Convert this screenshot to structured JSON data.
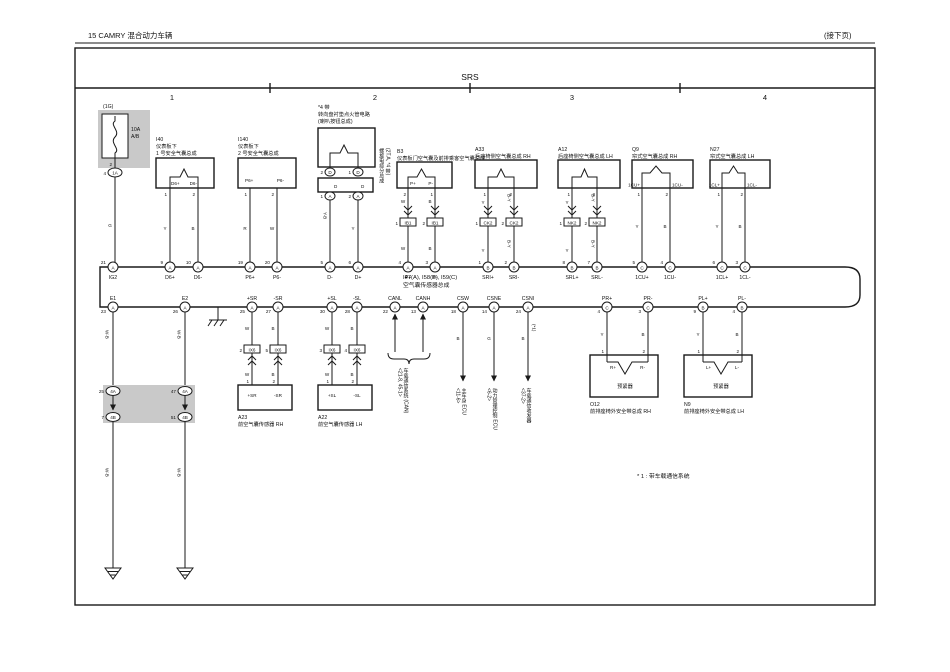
{
  "page": {
    "header_left": "15   CAMRY 混合动力车辆",
    "header_right": "(接下页)",
    "title": "SRS",
    "s1": "1",
    "s2": "2",
    "s3": "3",
    "s4": "4",
    "footnote": "* 1 : 带车载通信系统"
  },
  "fuse": {
    "conn": "(1G)",
    "amp": "10A",
    "name": "A/B",
    "pin": "2",
    "num": "4",
    "letter": "1A",
    "color": "G"
  },
  "ecu": {
    "l1": "I47(A), I58(B), I59(C)",
    "l2": "空气囊传感器总成",
    "top": [
      {
        "n": "21",
        "l": "A",
        "t": "IG2"
      },
      {
        "n": "9",
        "l": "A",
        "t": "D6+"
      },
      {
        "n": "10",
        "l": "A",
        "t": "D6-"
      },
      {
        "n": "19",
        "l": "A",
        "t": "P6+"
      },
      {
        "n": "20",
        "l": "A",
        "t": "P6-"
      },
      {
        "n": "5",
        "l": "A",
        "t": "D-"
      },
      {
        "n": "6",
        "l": "A",
        "t": "D+"
      },
      {
        "n": "4",
        "l": "A",
        "t": "P+"
      },
      {
        "n": "3",
        "l": "A",
        "t": "P-"
      },
      {
        "n": "1",
        "l": "B",
        "t": "SRI+"
      },
      {
        "n": "2",
        "l": "B",
        "t": "SRI-"
      },
      {
        "n": "8",
        "l": "B",
        "t": "SRL+"
      },
      {
        "n": "7",
        "l": "B",
        "t": "SRL-"
      },
      {
        "n": "5",
        "l": "C",
        "t": "1CU+"
      },
      {
        "n": "4",
        "l": "C",
        "t": "1CU-"
      },
      {
        "n": "6",
        "l": "C",
        "t": "1CL+"
      },
      {
        "n": "3",
        "l": "C",
        "t": "1CL-"
      }
    ],
    "bot": [
      {
        "n": "23",
        "l": "A",
        "t": "E1"
      },
      {
        "n": "26",
        "l": "A",
        "t": "E2"
      },
      {
        "n": "25",
        "l": "A",
        "t": "+SR"
      },
      {
        "n": "27",
        "l": "A",
        "t": "-SR"
      },
      {
        "n": "30",
        "l": "A",
        "t": "+SL"
      },
      {
        "n": "28",
        "l": "A",
        "t": "-SL"
      },
      {
        "n": "22",
        "l": "A",
        "t": "CANL"
      },
      {
        "n": "13",
        "l": "A",
        "t": "CANH"
      },
      {
        "n": "18",
        "l": "A",
        "t": "CSW"
      },
      {
        "n": "14",
        "l": "A",
        "t": "CSNE"
      },
      {
        "n": "24",
        "l": "A",
        "t": "CSNI"
      },
      {
        "n": "4",
        "l": "C",
        "t": "PR+"
      },
      {
        "n": "3",
        "l": "C",
        "t": "PR-"
      },
      {
        "n": "9",
        "l": "B",
        "t": "PL+"
      },
      {
        "n": "4",
        "l": "B",
        "t": "PL-"
      }
    ]
  },
  "i40": {
    "code": "I40",
    "l1": "仪表板下",
    "l2": "1 号安全气囊总成",
    "t1": "D6+",
    "t2": "D6-",
    "p1": "1",
    "p2": "2",
    "c1": "Y",
    "c2": "B"
  },
  "i140": {
    "code": "I140",
    "l1": "仪表板下",
    "l2": "2 号安全气囊总成",
    "t1": "P6+",
    "t2": "P6-",
    "p1": "1",
    "p2": "2",
    "c1": "R",
    "c2": "W"
  },
  "sp": {
    "n1": "*4 带",
    "n2": "转向盘衬垫点火管电路",
    "n3": "(喇叭按钮总成)",
    "side": "(2T.A, *4 带)\n螺旋电缆分总成",
    "u1n": "2",
    "u1l": "D",
    "u2n": "1",
    "u2l": "D",
    "b1": "D",
    "b2": "D",
    "d1n": "1",
    "d1l": "A",
    "d2n": "2",
    "d2l": "A",
    "c1": "Y-B",
    "c2": "Y"
  },
  "b3": {
    "code": "B3",
    "name": "仪表板门空气囊及前排乘客空气囊总成",
    "t1": "P+",
    "t2": "P-",
    "p1": "2",
    "p2": "1",
    "c1": "W",
    "c2": "B",
    "k": "IB1",
    "k1n": "1",
    "k2n": "2",
    "d1": "W",
    "d2": "B"
  },
  "a33": {
    "code": "A33",
    "name": "后座椅侧空气囊总成 RH",
    "p1": "1",
    "p2": "2",
    "c1": "Y",
    "c2": "B-Y",
    "k": "CK2",
    "k1n": "1",
    "k2n": "2",
    "d1": "Y",
    "d2": "B-Y"
  },
  "a12": {
    "code": "A12",
    "name": "后座椅侧空气囊总成 LH",
    "p1": "1",
    "p2": "2",
    "c1": "Y",
    "c2": "B-Y",
    "k": "NK2",
    "k1n": "1",
    "k2n": "2",
    "d1": "Y",
    "d2": "B-Y"
  },
  "q9": {
    "code": "Q9",
    "name": "帘式空气囊总成 RH",
    "t1": "1CU+",
    "t2": "1CU-",
    "p1": "1",
    "p2": "2",
    "c1": "Y",
    "c2": "B"
  },
  "n27": {
    "code": "N27",
    "name": "帘式空气囊总成 LH",
    "t1": "1CL+",
    "t2": "1CL-",
    "p1": "1",
    "p2": "2",
    "c1": "Y",
    "c2": "B"
  },
  "a23": {
    "code": "A23",
    "name": "前空气囊传感器 RH",
    "t1": "+SR",
    "t2": "-SR",
    "p1": "1",
    "p2": "2"
  },
  "a22": {
    "code": "A22",
    "name": "前空气囊传感器 LH",
    "t1": "+SL",
    "t2": "-SL",
    "p1": "1",
    "p2": "2"
  },
  "o12": {
    "code": "O12",
    "name": "前排座椅外安全带总成 RH",
    "t1": "R+",
    "t2": "R-",
    "p1": "1",
    "p2": "2",
    "inner": "预紧器"
  },
  "n9": {
    "code": "N9",
    "name": "前排座椅外安全带总成 LH",
    "t1": "L+",
    "t2": "L-",
    "p1": "1",
    "p2": "2",
    "inner": "预紧器"
  },
  "jb": {
    "tln": "25",
    "tll": "4A",
    "bln": "7",
    "bll": "4B",
    "trn": "47",
    "trl": "4A",
    "brn": "51",
    "brl": "4B",
    "e1c": "W-B",
    "e2c": "W-B",
    "e1d": "W-B",
    "e2d": "W-B"
  },
  "ix": {
    "k": "IX6",
    "n1": "2",
    "n2": "5",
    "n3": "3",
    "n4": "4",
    "c1": "W",
    "c2": "B",
    "c3": "W",
    "c4": "B",
    "d1": "W",
    "d2": "B",
    "d3": "W",
    "d4": "B"
  },
  "lk": {
    "can": "车载通信系统 (CAN)\n<21-8, 45-1>",
    "csw": "主车身 ECU\n<11-6>",
    "cswc": "B",
    "csne": "动力管理控制 ECU\n<6-2>",
    "csnec": "G",
    "csni": "车载通信收发器\n<37-2>",
    "csnic": "B",
    "star": "(*1)",
    "prc1": "Y",
    "prc2": "B",
    "plc1": "Y",
    "plc2": "B"
  }
}
